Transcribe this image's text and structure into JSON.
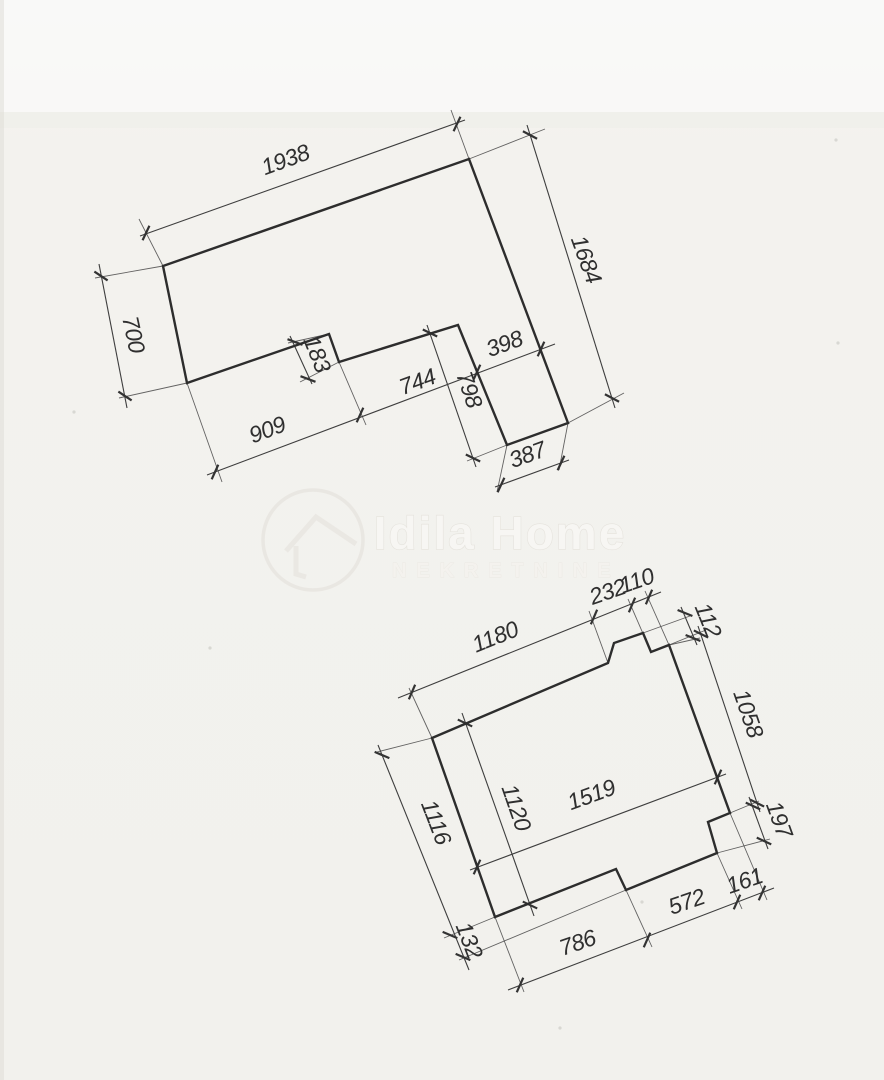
{
  "page": {
    "width": 884,
    "height": 1080,
    "paper_color": "#f3f2ee",
    "outline_color": "#2d2d2d",
    "dim_line_color": "#3e3e3e",
    "ext_line_color": "#4a4a4a",
    "text_color": "#2f2f2f",
    "watermark_stroke": "#e5e3dd",
    "watermark_fill": "#f7f6f3"
  },
  "watermark": {
    "line1": "Idila Home",
    "line2": "NEKRETNINE",
    "logo": "house-in-circle-icon",
    "circle": {
      "cx": 313,
      "cy": 540,
      "r": 50
    },
    "roof": "M286,551 L316,517 L356,544",
    "wall": "M296,546 L296,574 L306,577"
  },
  "figures": [
    {
      "name": "upper-plot-outline",
      "polygon": [
        [
          163,
          266
        ],
        [
          469,
          159
        ],
        [
          568,
          423
        ],
        [
          507,
          445
        ],
        [
          458,
          325
        ],
        [
          339,
          362
        ],
        [
          329,
          334
        ],
        [
          187,
          383
        ]
      ],
      "dims": [
        {
          "line": [
            140,
            236,
            465,
            120
          ],
          "ticks": [
            [
              146,
              233
            ],
            [
              457,
              124
            ]
          ]
        },
        {
          "line": [
            527,
            125,
            615,
            408
          ],
          "ticks": [
            [
              530,
              135
            ],
            [
              612,
              398
            ]
          ]
        },
        {
          "line": [
            99,
            264,
            127,
            408
          ],
          "ticks": [
            [
              101,
              276
            ],
            [
              125,
              396
            ]
          ]
        },
        {
          "line": [
            207,
            475,
            555,
            344
          ],
          "ticks": [
            [
              215,
              472
            ],
            [
              360,
              415
            ],
            [
              477,
              372
            ],
            [
              541,
              349
            ]
          ]
        },
        {
          "line": [
            290,
            336,
            312,
            384
          ],
          "ticks": [
            [
              295,
              342
            ],
            [
              308,
              379
            ]
          ]
        },
        {
          "line": [
            427,
            325,
            476,
            467
          ],
          "ticks": [
            [
              430,
              333
            ],
            [
              473,
              458
            ]
          ]
        },
        {
          "line": [
            495,
            487,
            569,
            460
          ],
          "ticks": [
            [
              501,
              485
            ],
            [
              561,
              463
            ]
          ]
        }
      ],
      "exts": [
        [
          163,
          266,
          139,
          219
        ],
        [
          469,
          159,
          451,
          110
        ],
        [
          469,
          159,
          545,
          129
        ],
        [
          568,
          423,
          624,
          393
        ],
        [
          163,
          266,
          95,
          278
        ],
        [
          187,
          383,
          119,
          398
        ],
        [
          187,
          383,
          222,
          482
        ],
        [
          339,
          362,
          366,
          425
        ],
        [
          329,
          334,
          288,
          343
        ],
        [
          339,
          362,
          300,
          382
        ],
        [
          507,
          445,
          467,
          461
        ],
        [
          507,
          445,
          497,
          492
        ],
        [
          568,
          423,
          559,
          470
        ]
      ],
      "labels": [
        {
          "text": "1938",
          "x": 288,
          "y": 167,
          "rot": -20
        },
        {
          "text": "1684",
          "x": 579,
          "y": 262,
          "rot": 70
        },
        {
          "text": "700",
          "x": 126,
          "y": 336,
          "rot": 78
        },
        {
          "text": "909",
          "x": 270,
          "y": 437,
          "rot": -21
        },
        {
          "text": "744",
          "x": 420,
          "y": 389,
          "rot": -20
        },
        {
          "text": "398",
          "x": 507,
          "y": 351,
          "rot": -20
        },
        {
          "text": "183",
          "x": 310,
          "y": 357,
          "rot": 68
        },
        {
          "text": "798",
          "x": 462,
          "y": 392,
          "rot": 71
        },
        {
          "text": "387",
          "x": 530,
          "y": 462,
          "rot": -20
        }
      ]
    },
    {
      "name": "lower-plot-outline",
      "polygon": [
        [
          432,
          738
        ],
        [
          608,
          663
        ],
        [
          614,
          643
        ],
        [
          643,
          633
        ],
        [
          651,
          652
        ],
        [
          669,
          645
        ],
        [
          730,
          813
        ],
        [
          708,
          822
        ],
        [
          717,
          853
        ],
        [
          626,
          890
        ],
        [
          616,
          869
        ],
        [
          495,
          917
        ]
      ],
      "dims": [
        {
          "line": [
            398,
            698,
            661,
            592
          ],
          "ticks": [
            [
              412,
              692
            ],
            [
              594,
              617
            ],
            [
              632,
              605
            ],
            [
              649,
              597
            ]
          ]
        },
        {
          "line": [
            681,
            607,
            697,
            645
          ],
          "ticks": [
            [
              685,
              613
            ],
            [
              693,
              638
            ]
          ]
        },
        {
          "line": [
            698,
            626,
            760,
            812
          ],
          "ticks": [
            [
              701,
              634
            ],
            [
              757,
              803
            ]
          ]
        },
        {
          "line": [
            749,
            797,
            768,
            849
          ],
          "ticks": [
            [
              753,
              806
            ],
            [
              764,
              841
            ]
          ]
        },
        {
          "line": [
            470,
            870,
            726,
            774
          ],
          "ticks": [
            [
              477,
              867
            ],
            [
              718,
              777
            ]
          ]
        },
        {
          "line": [
            462,
            713,
            534,
            916
          ],
          "ticks": [
            [
              465,
              723
            ],
            [
              530,
              905
            ]
          ]
        },
        {
          "line": [
            378,
            745,
            469,
            970
          ],
          "ticks": [
            [
              382,
              755
            ],
            [
              450,
              935
            ],
            [
              463,
              957
            ]
          ]
        },
        {
          "line": [
            508,
            990,
            774,
            888
          ],
          "ticks": [
            [
              520,
              985
            ],
            [
              647,
              940
            ],
            [
              737,
              902
            ],
            [
              762,
              893
            ]
          ]
        }
      ],
      "exts": [
        [
          432,
          738,
          409,
          688
        ],
        [
          608,
          663,
          589,
          611
        ],
        [
          651,
          652,
          628,
          599
        ],
        [
          669,
          645,
          645,
          591
        ],
        [
          643,
          633,
          690,
          616
        ],
        [
          669,
          645,
          700,
          638
        ],
        [
          669,
          645,
          706,
          630
        ],
        [
          730,
          813,
          759,
          801
        ],
        [
          717,
          853,
          770,
          839
        ],
        [
          432,
          738,
          377,
          752
        ],
        [
          495,
          917,
          444,
          938
        ],
        [
          626,
          890,
          459,
          960
        ],
        [
          495,
          917,
          524,
          992
        ],
        [
          626,
          890,
          652,
          947
        ],
        [
          717,
          853,
          742,
          909
        ],
        [
          730,
          813,
          767,
          900
        ]
      ],
      "labels": [
        {
          "text": "1180",
          "x": 498,
          "y": 644,
          "rot": -22
        },
        {
          "text": "232",
          "x": 610,
          "y": 599,
          "rot": -19
        },
        {
          "text": "110",
          "x": 639,
          "y": 588,
          "rot": -19
        },
        {
          "text": "112",
          "x": 701,
          "y": 623,
          "rot": 68
        },
        {
          "text": "1058",
          "x": 741,
          "y": 716,
          "rot": 71
        },
        {
          "text": "197",
          "x": 772,
          "y": 822,
          "rot": 70
        },
        {
          "text": "1519",
          "x": 594,
          "y": 802,
          "rot": -20
        },
        {
          "text": "1120",
          "x": 509,
          "y": 810,
          "rot": 71
        },
        {
          "text": "1116",
          "x": 429,
          "y": 825,
          "rot": 69
        },
        {
          "text": "132",
          "x": 462,
          "y": 943,
          "rot": 69
        },
        {
          "text": "786",
          "x": 580,
          "y": 950,
          "rot": -19
        },
        {
          "text": "572",
          "x": 689,
          "y": 909,
          "rot": -19
        },
        {
          "text": "161",
          "x": 747,
          "y": 888,
          "rot": -19
        }
      ]
    }
  ],
  "specks": [
    [
      74,
      412
    ],
    [
      838,
      343
    ],
    [
      642,
      902
    ],
    [
      210,
      648
    ],
    [
      560,
      1028
    ],
    [
      836,
      140
    ]
  ]
}
